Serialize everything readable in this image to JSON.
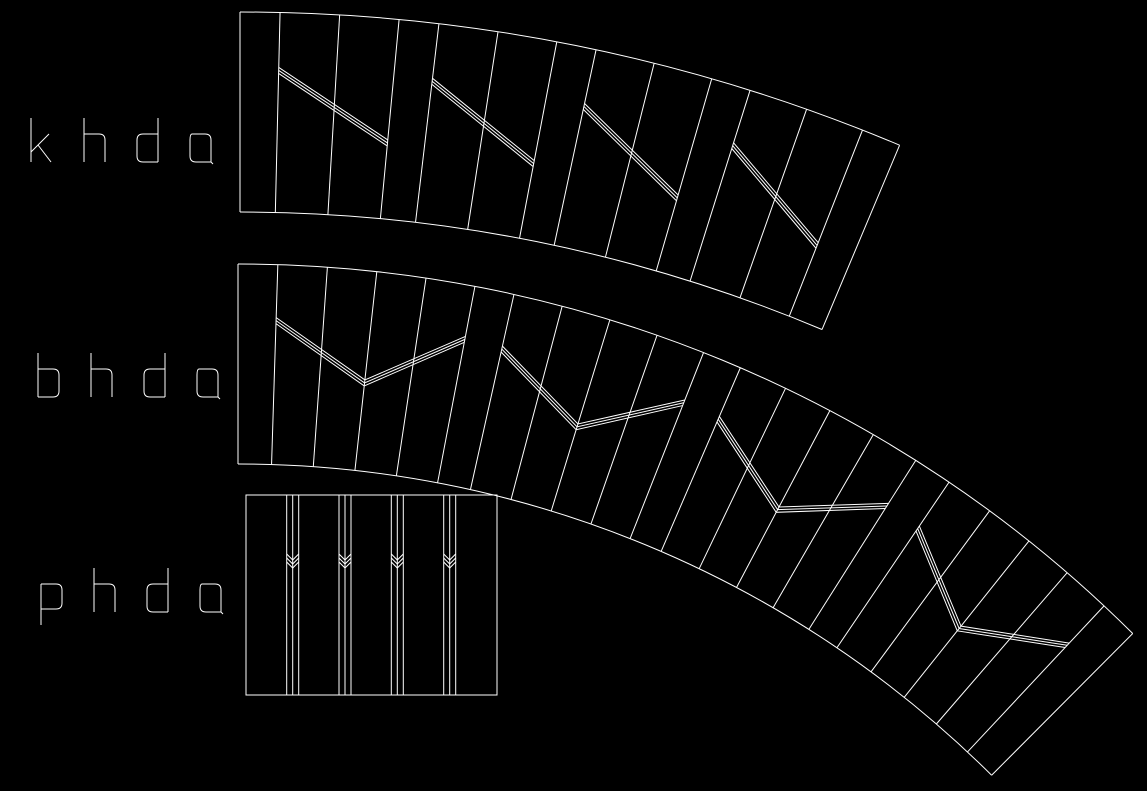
{
  "canvas": {
    "width": 1147,
    "height": 791,
    "background": "#000000",
    "line_color": "#ffffff"
  },
  "entities": [
    {
      "id": "khda_band",
      "type": "arc_band",
      "label": {
        "text": "khda",
        "x": 28,
        "y": 118
      },
      "geometry": {
        "cx": 240,
        "cy": 1712,
        "r_outer": 1700,
        "r_inner": 1500,
        "narrow_deg": 1.35,
        "wide_deg": 2.01,
        "groups": 4,
        "wides_per_group": 2,
        "mark": "diagonal",
        "mark_start_frac": 0.29,
        "mark_end_frac": 0.62,
        "triple_offset": 3
      }
    },
    {
      "id": "bhda_band",
      "type": "arc_band",
      "label": {
        "text": "bhda",
        "x": 35,
        "y": 353
      },
      "geometry": {
        "cx": 238,
        "cy": 1532,
        "r_outer": 1268,
        "r_inner": 1068,
        "narrow_deg": 1.8,
        "wide_deg": 2.2425,
        "groups": 4,
        "wides_per_group": 4,
        "mark": "chevron",
        "mark_start_frac": 0.28,
        "mark_vertex_frac": 0.56,
        "mark_end_frac": 0.27,
        "triple_offset": 3
      }
    },
    {
      "id": "phda_panel",
      "type": "rect_panel",
      "label": {
        "text": "phda",
        "x": 38,
        "y": 568
      },
      "geometry": {
        "x": 246,
        "y": 495,
        "width": 251,
        "height": 200,
        "line_groups_x": [
          292.7,
          345,
          397.3,
          449.7
        ],
        "triple_offset": 6,
        "chevrons": {
          "count": 3,
          "first_vertex_y": 560,
          "step": 4,
          "half_width": 6,
          "depth": 6
        }
      }
    }
  ]
}
